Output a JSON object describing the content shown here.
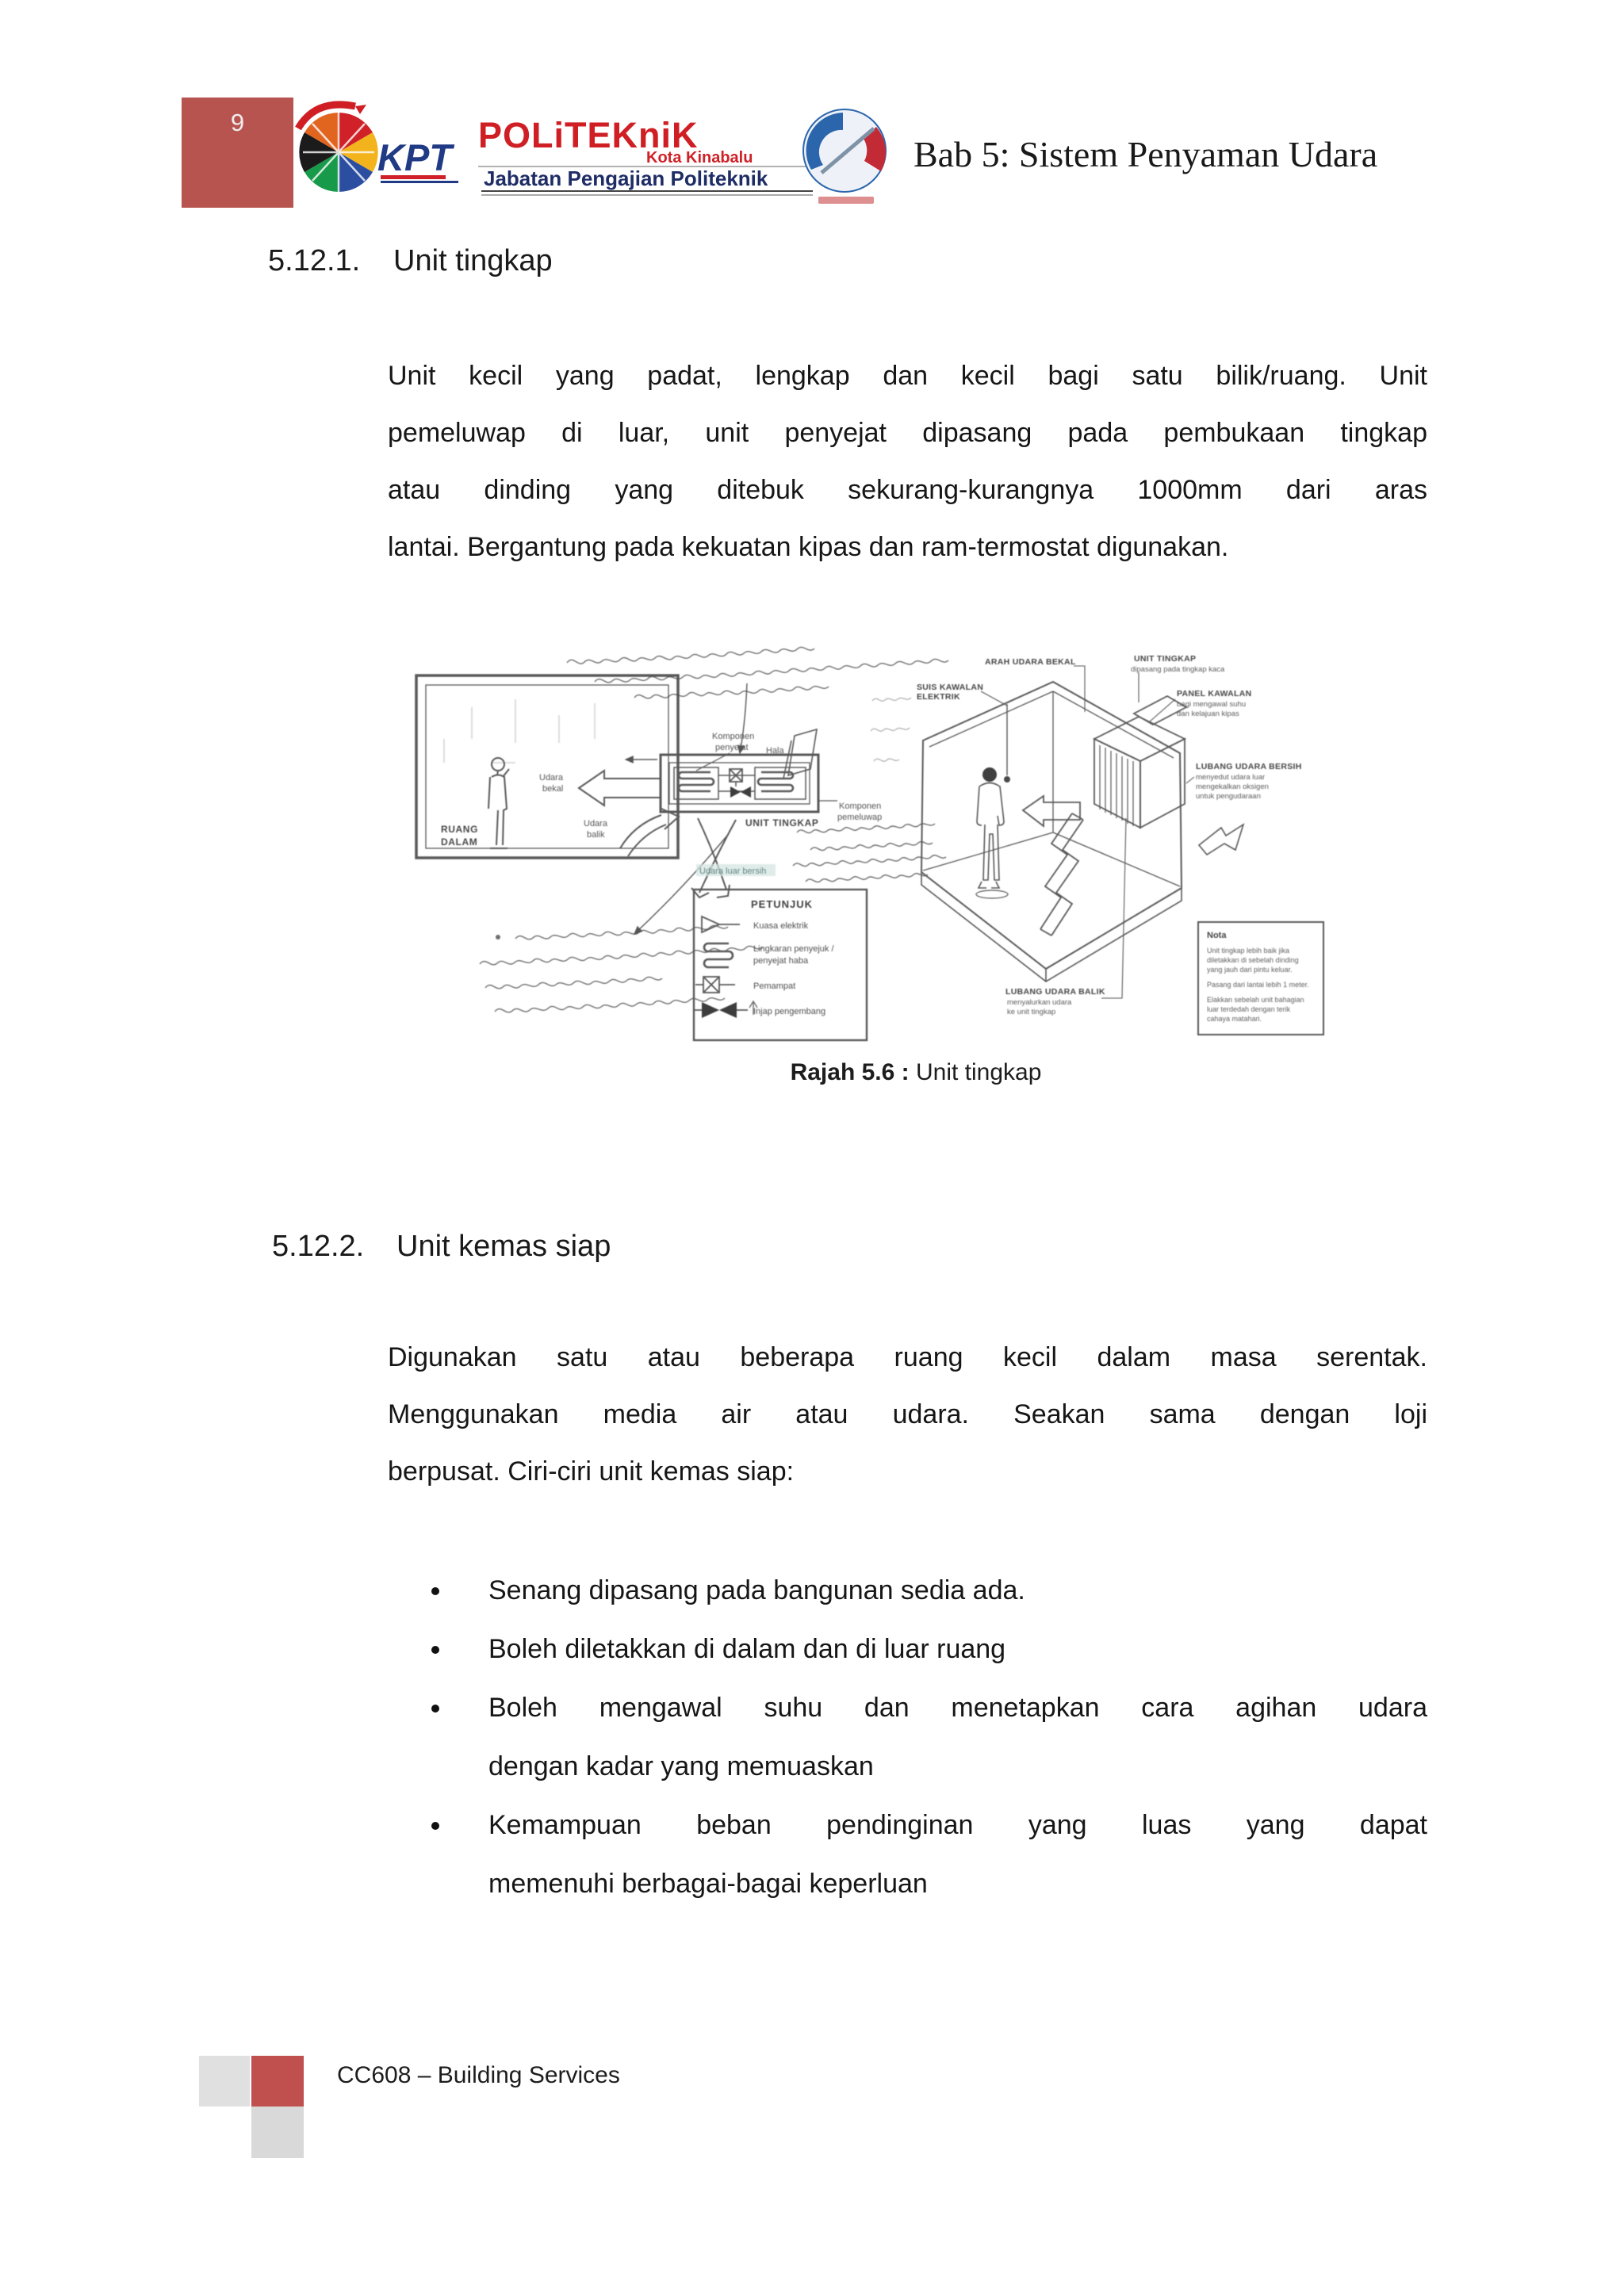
{
  "page": {
    "number": "9"
  },
  "header": {
    "title": "Bab 5: Sistem Penyaman Udara",
    "kpt": "KPT",
    "politeknik": "POLiTEKniK",
    "kota": "Kota Kinabalu",
    "jabatan": "Jabatan Pengajian Politeknik"
  },
  "sections": [
    {
      "number": "5.12.1.",
      "title": "Unit tingkap",
      "lines": [
        "Unit kecil yang padat, lengkap dan kecil bagi satu bilik/ruang. Unit",
        "pemeluwap di luar, unit penyejat dipasang pada pembukaan tingkap",
        "atau dinding yang ditebuk sekurang-kurangnya 1000mm dari aras",
        "lantai. Bergantung pada kekuatan kipas dan ram-termostat digunakan."
      ]
    },
    {
      "number": "5.12.2.",
      "title": "Unit kemas siap",
      "lines": [
        "Digunakan satu atau beberapa ruang kecil dalam masa serentak.",
        "Menggunakan media air atau udara. Seakan sama dengan loji",
        "berpusat. Ciri-ciri unit kemas siap:"
      ],
      "bullets": [
        {
          "l1": "Senang dipasang pada bangunan sedia ada."
        },
        {
          "l1": "Boleh diletakkan di dalam dan di luar ruang"
        },
        {
          "l1": "Boleh mengawal suhu dan menetapkan cara agihan udara",
          "l2": "dengan kadar yang memuaskan"
        },
        {
          "l1": "Kemampuan beban pendinginan yang luas yang dapat",
          "l2": "memenuhi berbagai-bagai  keperluan"
        }
      ]
    }
  ],
  "figure": {
    "caption_label": "Rajah 5.6 :",
    "caption_title": "Unit tingkap",
    "handwritten_note": "(illegible handwritten annotations on scanned diagram)",
    "left": {
      "room1": "RUANG",
      "room2": "DALAM",
      "supply1": "Udara",
      "supply2": "bekal",
      "return1": "Udara",
      "return2": "balik",
      "evap1": "Komponen",
      "evap2": "penyejat",
      "hala": "Hala",
      "cond1": "Komponen",
      "cond2": "pemeluwap",
      "unit": "UNIT TINGKAP",
      "fresh": "Udara luar bersih",
      "legend_title": "PETUNJUK",
      "leg1": "Kuasa elektrik",
      "leg2a": "Lingkaran penyejuk /",
      "leg2b": "penyejat haba",
      "leg3": "Pemampat",
      "leg4": "Injap pengembang"
    },
    "right": {
      "arah": "ARAH UDARA BEKAL",
      "unit1": "UNIT TINGKAP",
      "unit2": "dipasang pada tingkap kaca",
      "suis1": "SUIS KAWALAN",
      "suis2": "ELEKTRIK",
      "panel1": "PANEL KAWALAN",
      "panel2": "bagi mengawal suhu",
      "panel3": "dan kelajuan kipas",
      "fresh1": "LUBANG UDARA BERSIH",
      "fresh2": "menyedut udara luar",
      "fresh3": "mengekalkan oksigen",
      "fresh4": "untuk pengudaraan",
      "balik1": "LUBANG UDARA BALIK",
      "balik2": "menyalurkan udara",
      "balik3": "ke unit tingkap",
      "nota_title": "Nota",
      "nota1": "Unit tingkap lebih baik jika",
      "nota2": "diletakkan di sebelah dinding",
      "nota3": "yang jauh dari pintu keluar.",
      "nota4": "Pasang dari lantai lebih 1 meter.",
      "nota5": "Elakkan sebelah unit bahagian",
      "nota6": "luar terdedah dengan terik",
      "nota7": "cahaya matahari."
    }
  },
  "footer": {
    "text": "CC608 – Building Services"
  }
}
